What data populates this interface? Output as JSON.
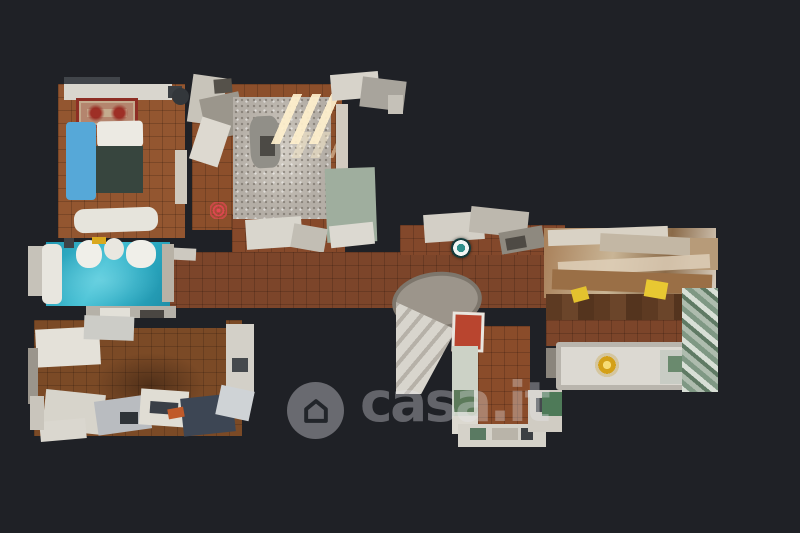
{
  "page": {
    "background_color": "#1f2126",
    "content_type": "3d-dollhouse-floorplan-photo"
  },
  "watermark": {
    "brand_text": "casa.it",
    "icon": "house-icon",
    "tint": "rgba(233,233,238,0.36)"
  },
  "markers": [
    {
      "name": "camera-position-marker",
      "shape": "teal-ring-dot",
      "color": "#2f8f8a",
      "x": 461,
      "y": 248
    },
    {
      "name": "viewpoint-marker",
      "shape": "red-bullseye",
      "color": "#eb4655",
      "x": 218,
      "y": 210
    }
  ],
  "palette": {
    "floor_terracotta": "#8c4f2b",
    "floor_corridor": "#7c452a",
    "bathroom_teal": "#2aa8c0",
    "bed_blanket_blue": "#56a8d8",
    "bed_duvet_dark": "#37453e",
    "rug_gray": "#b6b0a8",
    "rug_oriental_red": "#9e2f26",
    "wood_floor": "#5d3a22",
    "gold_accent": "#d4a017",
    "furniture_white": "#dcd9d2"
  }
}
